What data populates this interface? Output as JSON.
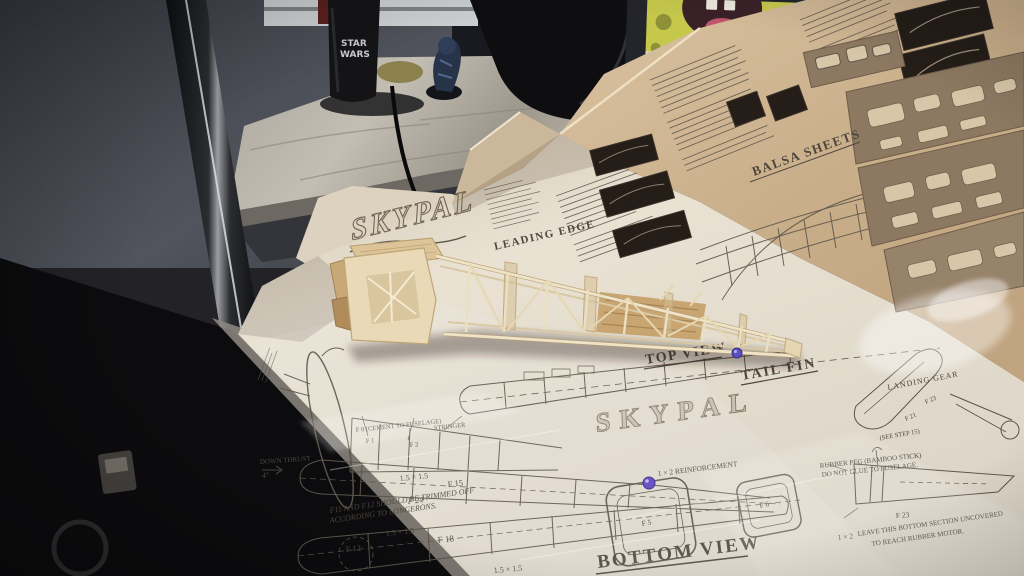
{
  "background": {
    "mug_line1": "STAR",
    "mug_line2": "WARS"
  },
  "plan": {
    "logo": "SKYPAL",
    "logo_mid": "SKYPAL",
    "labels": {
      "leading_edge": "LEADING EDGE",
      "top_view": "TOP VIEW",
      "tail_fin": "TAIL FIN",
      "bottom_view": "BOTTOM VIEW",
      "balsa_sheets": "BALSA SHEETS",
      "landing_gear": "LANDING GEAR",
      "down_thrust": "DOWN THRUST",
      "down_thrust_angle": "4°",
      "see_step": "(SEE STEP 15)"
    },
    "notes": {
      "trim_1": "F11 AND F12 SHOULD BE TRIMMED OFF",
      "trim_2": "ACCORDING TO LONGERONS.",
      "rubber_peg_1": "RUBBER PEG (BAMBOO STICK)",
      "rubber_peg_2": "DO NOT GLUE TO FUSELAGE.",
      "uncover_1": "LEAVE THIS BOTTOM SECTION UNCOVERED",
      "uncover_2": "TO REACH RUBBER MOTOR.",
      "reinforcement": "1 × 2 REINFORCEMENT",
      "cement": "F 8 (CEMENT TO FUSELAGE)",
      "stringer": "STRINGER"
    },
    "parts": {
      "f1": "F 1",
      "f2": "F 2",
      "f5": "F 5",
      "f6": "F 6",
      "f12": "F 12",
      "f15": "F 15",
      "f18": "F 18",
      "f21": "F 21",
      "f23a": "F 23",
      "f23b": "F 23",
      "f24": "F 24",
      "sq1": "1.5 × 1.5",
      "sq2": "1.5 × 1.5",
      "sq3": "1.5 × 1.5",
      "one_by_two": "1 × 2"
    }
  }
}
